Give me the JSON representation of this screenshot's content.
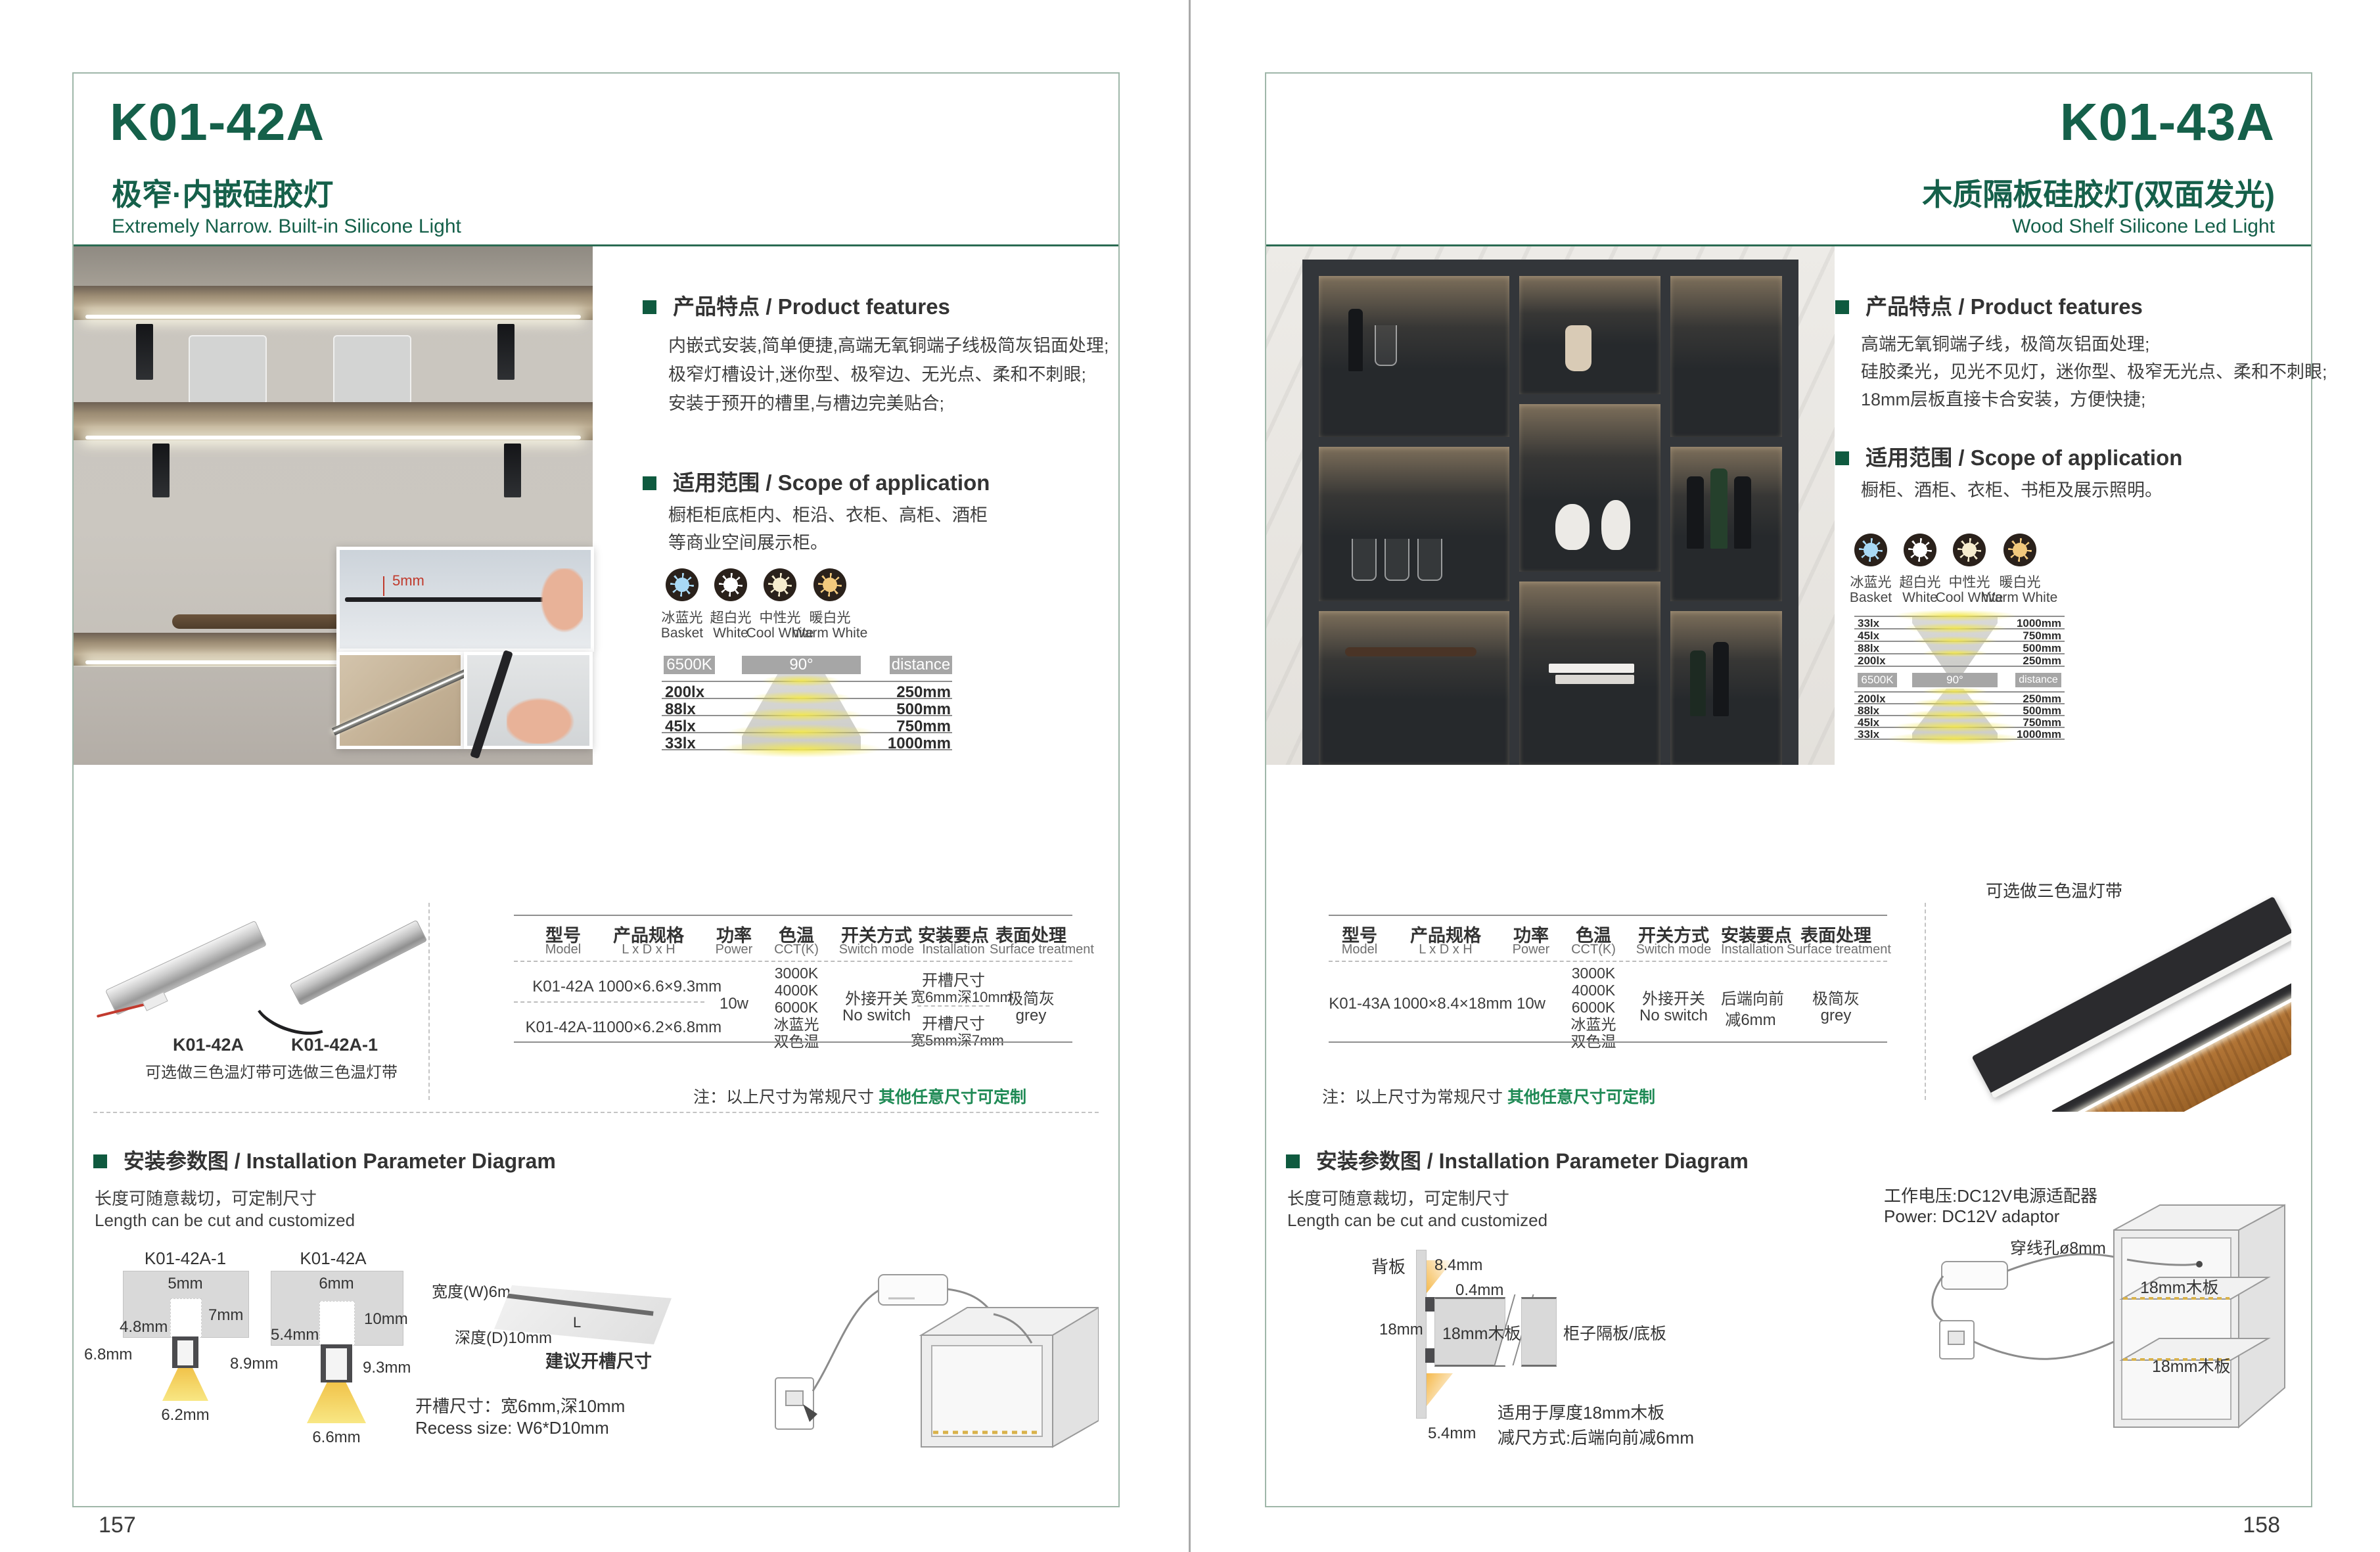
{
  "theme": {
    "accent_green": "#15604a",
    "bullet_green": "#0f5a3f",
    "note_green": "#1f8a55",
    "chip_gray": "#a6a6a6",
    "led_yellow": "#f2e65a",
    "page_border": "#9fb7a9"
  },
  "shared": {
    "light_colors": [
      {
        "name": "ice-blue-light",
        "cn": "冰蓝光",
        "en": "Basket",
        "hex": "#a9d9f5"
      },
      {
        "name": "super-white-light",
        "cn": "超白光",
        "en": "White",
        "hex": "#ffffff"
      },
      {
        "name": "neutral-light",
        "cn": "中性光",
        "en": "Cool White",
        "hex": "#f6ecce"
      },
      {
        "name": "warm-white-light",
        "cn": "暖白光",
        "en": "Warm White",
        "hex": "#f2c97d"
      }
    ],
    "table_headers": [
      {
        "cn": "型号",
        "en": "Model"
      },
      {
        "cn": "产品规格",
        "en": "L x D x H"
      },
      {
        "cn": "功率",
        "en": "Power"
      },
      {
        "cn": "色温",
        "en": "CCT(K)"
      },
      {
        "cn": "开关方式",
        "en": "Switch mode"
      },
      {
        "cn": "安装要点",
        "en": "Installation"
      },
      {
        "cn": "表面处理",
        "en": "Surface treatment"
      }
    ],
    "install_heading": "安装参数图 / Installation Parameter Diagram",
    "cut_cn": "长度可随意裁切，可定制尺寸",
    "cut_en": "Length can be cut and customized",
    "note_prefix": "注：以上尺寸为常规尺寸 ",
    "note_highlight": "其他任意尺寸可定制"
  },
  "left": {
    "page_number": "157",
    "model": "K01-42A",
    "title_cn": "极窄·内嵌硅胶灯",
    "title_en": "Extremely Narrow. Built-in Silicone Light",
    "features_heading": "产品特点 / Product features",
    "features": [
      "内嵌式安装,简单便捷,高端无氧铜端子线极简灰铝面处理;",
      "极窄灯槽设计,迷你型、极窄边、无光点、柔和不刺眼;",
      "安装于预开的槽里,与槽边完美贴合;"
    ],
    "scope_heading": "适用范围 / Scope of application",
    "scope": [
      "橱柜柜底柜内、柜沿、衣柜、高柜、酒柜",
      "等商业空间展示柜。"
    ],
    "inset_dim": "5mm",
    "chart": {
      "cct": "6500K",
      "angle": "90°",
      "distance": "distance",
      "rows": [
        {
          "lx": "200lx",
          "mm": "250mm"
        },
        {
          "lx": "88lx",
          "mm": "500mm"
        },
        {
          "lx": "45lx",
          "mm": "750mm"
        },
        {
          "lx": "33lx",
          "mm": "1000mm"
        }
      ]
    },
    "products": [
      {
        "model": "K01-42A",
        "note": "可选做三色温灯带"
      },
      {
        "model": "K01-42A-1",
        "note": "可选做三色温灯带"
      }
    ],
    "table": {
      "rows": [
        {
          "model": "K01-42A",
          "size": "1000×6.6×9.3mm"
        },
        {
          "model": "K01-42A-1",
          "size": "1000×6.2×6.8mm"
        }
      ],
      "power": "10w",
      "cct": [
        "3000K",
        "4000K",
        "6000K",
        "冰蓝光",
        "双色温"
      ],
      "switch_cn": "外接开关",
      "switch_en": "No switch",
      "install_rows": [
        {
          "l1": "开槽尺寸",
          "l2": "宽6mm深10mm"
        },
        {
          "l1": "开槽尺寸",
          "l2": "宽5mm深7mm"
        }
      ],
      "surface_cn": "极简灰",
      "surface_en": "grey"
    },
    "install": {
      "d1_label": "K01-42A-1",
      "d1_top": "5mm",
      "d1_depth": "7mm",
      "d1_lip": "4.8mm",
      "d1_h": "6.8mm",
      "d1_w": "6.2mm",
      "d2_label": "K01-42A",
      "d2_top": "6mm",
      "d2_depth": "10mm",
      "d2_lip": "5.4mm",
      "d2_h": "8.9mm",
      "d2_h2": "9.3mm",
      "d2_w": "6.6mm",
      "recess_w": "宽度(W)6mm",
      "recess_d": "深度(D)10mm",
      "recess_hint": "建议开槽尺寸",
      "length": "L",
      "recess_cn": "开槽尺寸：宽6mm,深10mm",
      "recess_en": "Recess size: W6*D10mm"
    }
  },
  "right": {
    "page_number": "158",
    "model": "K01-43A",
    "title_cn": "木质隔板硅胶灯(双面发光)",
    "title_en": "Wood Shelf Silicone Led Light",
    "features_heading": "产品特点 / Product features",
    "features": [
      "高端无氧铜端子线，极简灰铝面处理;",
      "硅胶柔光，见光不见灯，迷你型、极窄无光点、柔和不刺眼;",
      "18mm层板直接卡合安装，方便快捷;"
    ],
    "scope_heading": "适用范围 / Scope of application",
    "scope": [
      "橱柜、酒柜、衣柜、书柜及展示照明。"
    ],
    "chart": {
      "cct": "6500K",
      "angle": "90°",
      "distance": "distance",
      "top_rows": [
        {
          "lx": "33lx",
          "mm": "1000mm"
        },
        {
          "lx": "45lx",
          "mm": "750mm"
        },
        {
          "lx": "88lx",
          "mm": "500mm"
        },
        {
          "lx": "200lx",
          "mm": "250mm"
        }
      ],
      "bottom_rows": [
        {
          "lx": "200lx",
          "mm": "250mm"
        },
        {
          "lx": "88lx",
          "mm": "500mm"
        },
        {
          "lx": "45lx",
          "mm": "750mm"
        },
        {
          "lx": "33lx",
          "mm": "1000mm"
        }
      ]
    },
    "product_note": "可选做三色温灯带",
    "table": {
      "row": {
        "model": "K01-43A",
        "size": "1000×8.4×18mm"
      },
      "power": "10w",
      "cct": [
        "3000K",
        "4000K",
        "6000K",
        "冰蓝光",
        "双色温"
      ],
      "switch_cn": "外接开关",
      "switch_en": "No switch",
      "install_l1": "后端向前",
      "install_l2": "减6mm",
      "surface_cn": "极简灰",
      "surface_en": "grey"
    },
    "install": {
      "back_panel": "背板",
      "dim_a": "8.4mm",
      "dim_b": "0.4mm",
      "dim_c": "18mm",
      "board": "18mm木板",
      "divider": "柜子隔板/底板",
      "dim_d": "5.4mm",
      "fit1": "适用于厚度18mm木板",
      "fit2": "减尺方式:后端向前减6mm",
      "power_cn": "工作电压:DC12V电源适配器",
      "power_en": "Power: DC12V adaptor",
      "hole": "穿线孔ø8mm",
      "shelf1": "18mm木板",
      "shelf2": "18mm木板"
    }
  }
}
